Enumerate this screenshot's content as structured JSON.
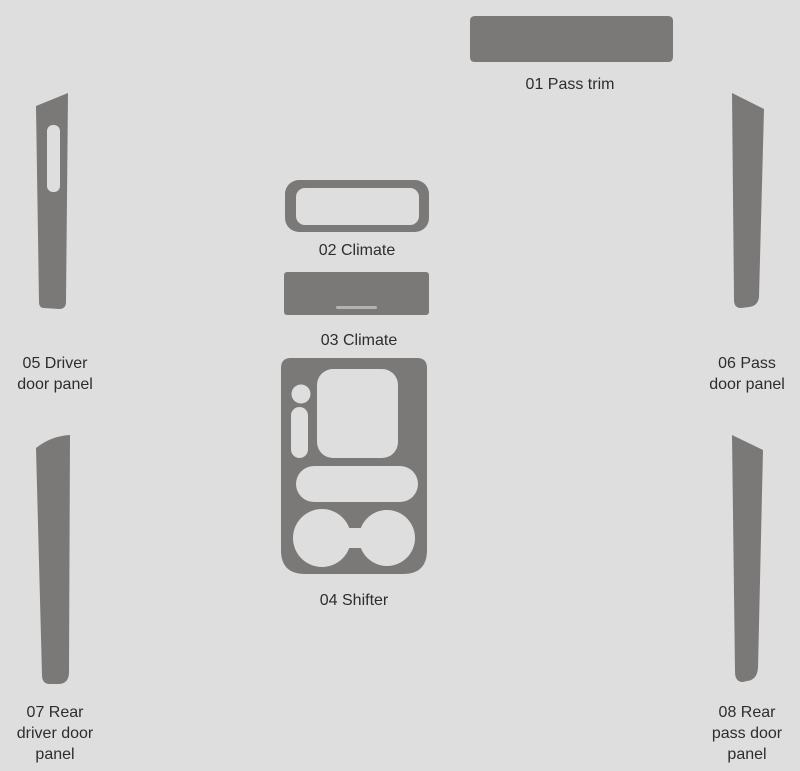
{
  "canvas": {
    "width": 800,
    "height": 771
  },
  "colors": {
    "background": "#dedede",
    "part_fill": "#7b7978",
    "cutout_fill": "#dedede",
    "detail_line": "#b3b2b0",
    "label_text": "#2d2d2d"
  },
  "diagram": {
    "parts": [
      {
        "id": "01",
        "label": "01 Pass trim",
        "lines": [
          "01 Pass trim"
        ]
      },
      {
        "id": "02",
        "label": "02 Climate",
        "lines": [
          "02 Climate"
        ]
      },
      {
        "id": "03",
        "label": "03 Climate",
        "lines": [
          "03 Climate"
        ]
      },
      {
        "id": "04",
        "label": "04 Shifter",
        "lines": [
          "04 Shifter"
        ]
      },
      {
        "id": "05",
        "label": "05 Driver door panel",
        "lines": [
          "05 Driver",
          "door panel"
        ]
      },
      {
        "id": "06",
        "label": "06 Pass door panel",
        "lines": [
          "06 Pass",
          "door panel"
        ]
      },
      {
        "id": "07",
        "label": "07 Rear driver door panel",
        "lines": [
          "07 Rear",
          "driver door",
          "panel"
        ]
      },
      {
        "id": "08",
        "label": "08 Rear pass door panel",
        "lines": [
          "08 Rear",
          "pass door",
          "panel"
        ]
      }
    ]
  }
}
